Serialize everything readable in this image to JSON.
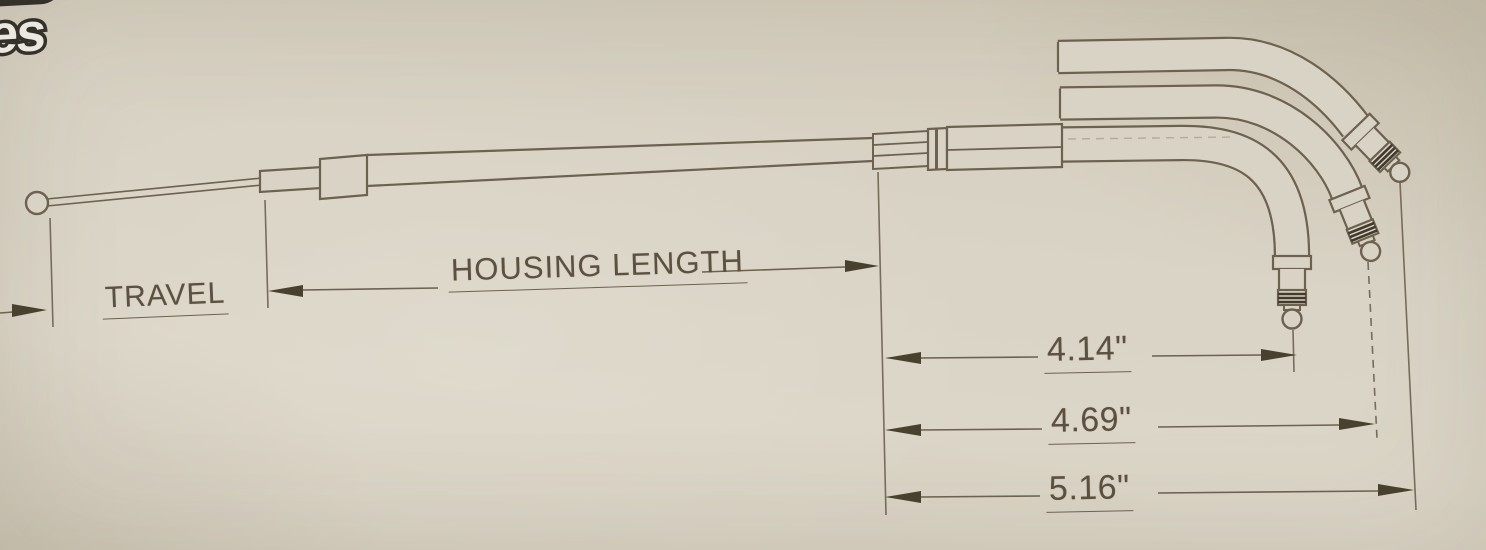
{
  "page": {
    "background_color": "#d7d1c3"
  },
  "logo": {
    "visible_fragment": "ties",
    "accent_color": "#4684c8"
  },
  "labels": {
    "travel": "TRAVEL",
    "housing_length": "HOUSING LENGTH"
  },
  "dimensions": {
    "dim_short": "4.14\"",
    "dim_medium": "4.69\"",
    "dim_long": "5.16\""
  },
  "colors": {
    "line": "#6d6150",
    "arrow": "#48412f",
    "text": "#5c5140",
    "paper_fill": "#d9d3c5"
  }
}
